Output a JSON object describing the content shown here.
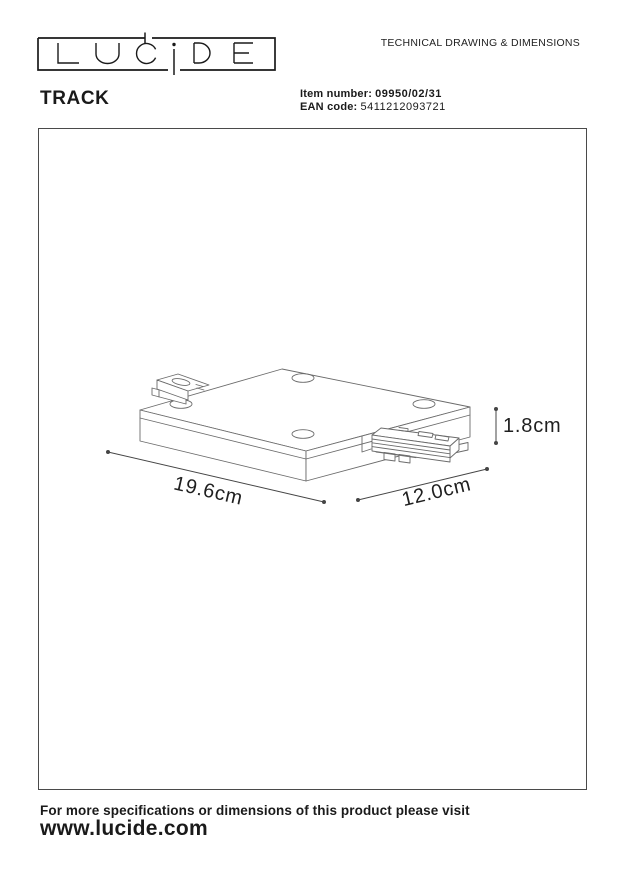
{
  "page": {
    "background": "#ffffff",
    "ink": "#1a1a1a"
  },
  "header": {
    "logo": "LUCIDE",
    "doc_title": "TECHNICAL DRAWING & DIMENSIONS",
    "product_name": "TRACK",
    "item_number_label": "Item number:",
    "item_number_value": "09950/02/31",
    "ean_label": "EAN code:",
    "ean_value": "5411212093721"
  },
  "drawing": {
    "description": "Isometric line drawing of a flat square track plate with four round holes, a small adapter block on the back-left edge and a multi-contact connector on the front-right edge",
    "dimensions": {
      "length": "19.6cm",
      "width": "12.0cm",
      "height": "1.8cm"
    }
  },
  "footer": {
    "note": "For more specifications or dimensions of this product please visit",
    "website": "www.lucide.com"
  }
}
